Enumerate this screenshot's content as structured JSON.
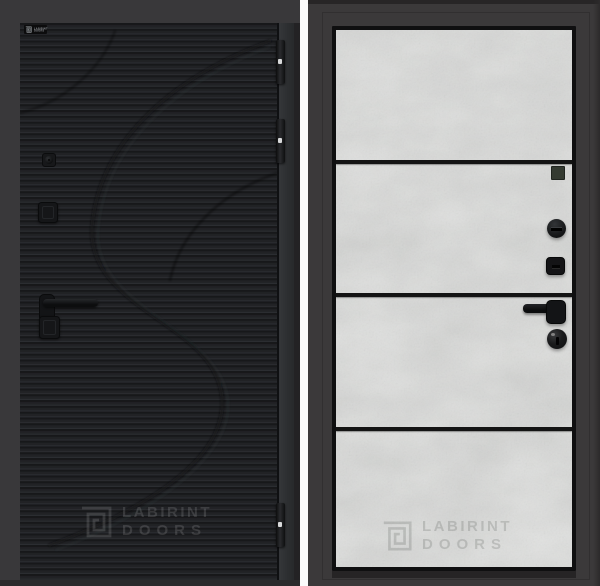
{
  "image": {
    "description": "Catalog photo: front and back views of a LABIRINT entrance door",
    "brand": "LABIRINT DOORS"
  },
  "front_view": {
    "logo_plate": {
      "line1": "LABIRINT",
      "line2": "DOORS"
    },
    "watermark": {
      "line1": "LABIRINT",
      "line2": "DOORS"
    },
    "hinge_count": 3,
    "hardware": [
      "cylinder-knob",
      "lock-escutcheon",
      "lever-handle",
      "lock-escutcheon"
    ]
  },
  "back_view": {
    "watermark": {
      "line1": "LABIRINT",
      "line2": "DOORS"
    },
    "panel_section_count": 4,
    "hardware": [
      "peephole",
      "thumb-turn",
      "lock-escutcheon",
      "lever-handle",
      "key-cylinder"
    ]
  },
  "colors": {
    "background": "#39383a",
    "front_leaf_black": "#1f2023",
    "front_leaf_edge": "#303234",
    "divider_gap_white": "#fbfbfb",
    "back_frame": "#3b393a",
    "concrete_grey": "#a7a9a8",
    "insert_stripe_black": "#141414",
    "hardware_black": "#161618",
    "watermark_on_black": "rgba(255,255,255,0.13)",
    "watermark_on_concrete": "rgba(30,35,30,0.16)"
  }
}
